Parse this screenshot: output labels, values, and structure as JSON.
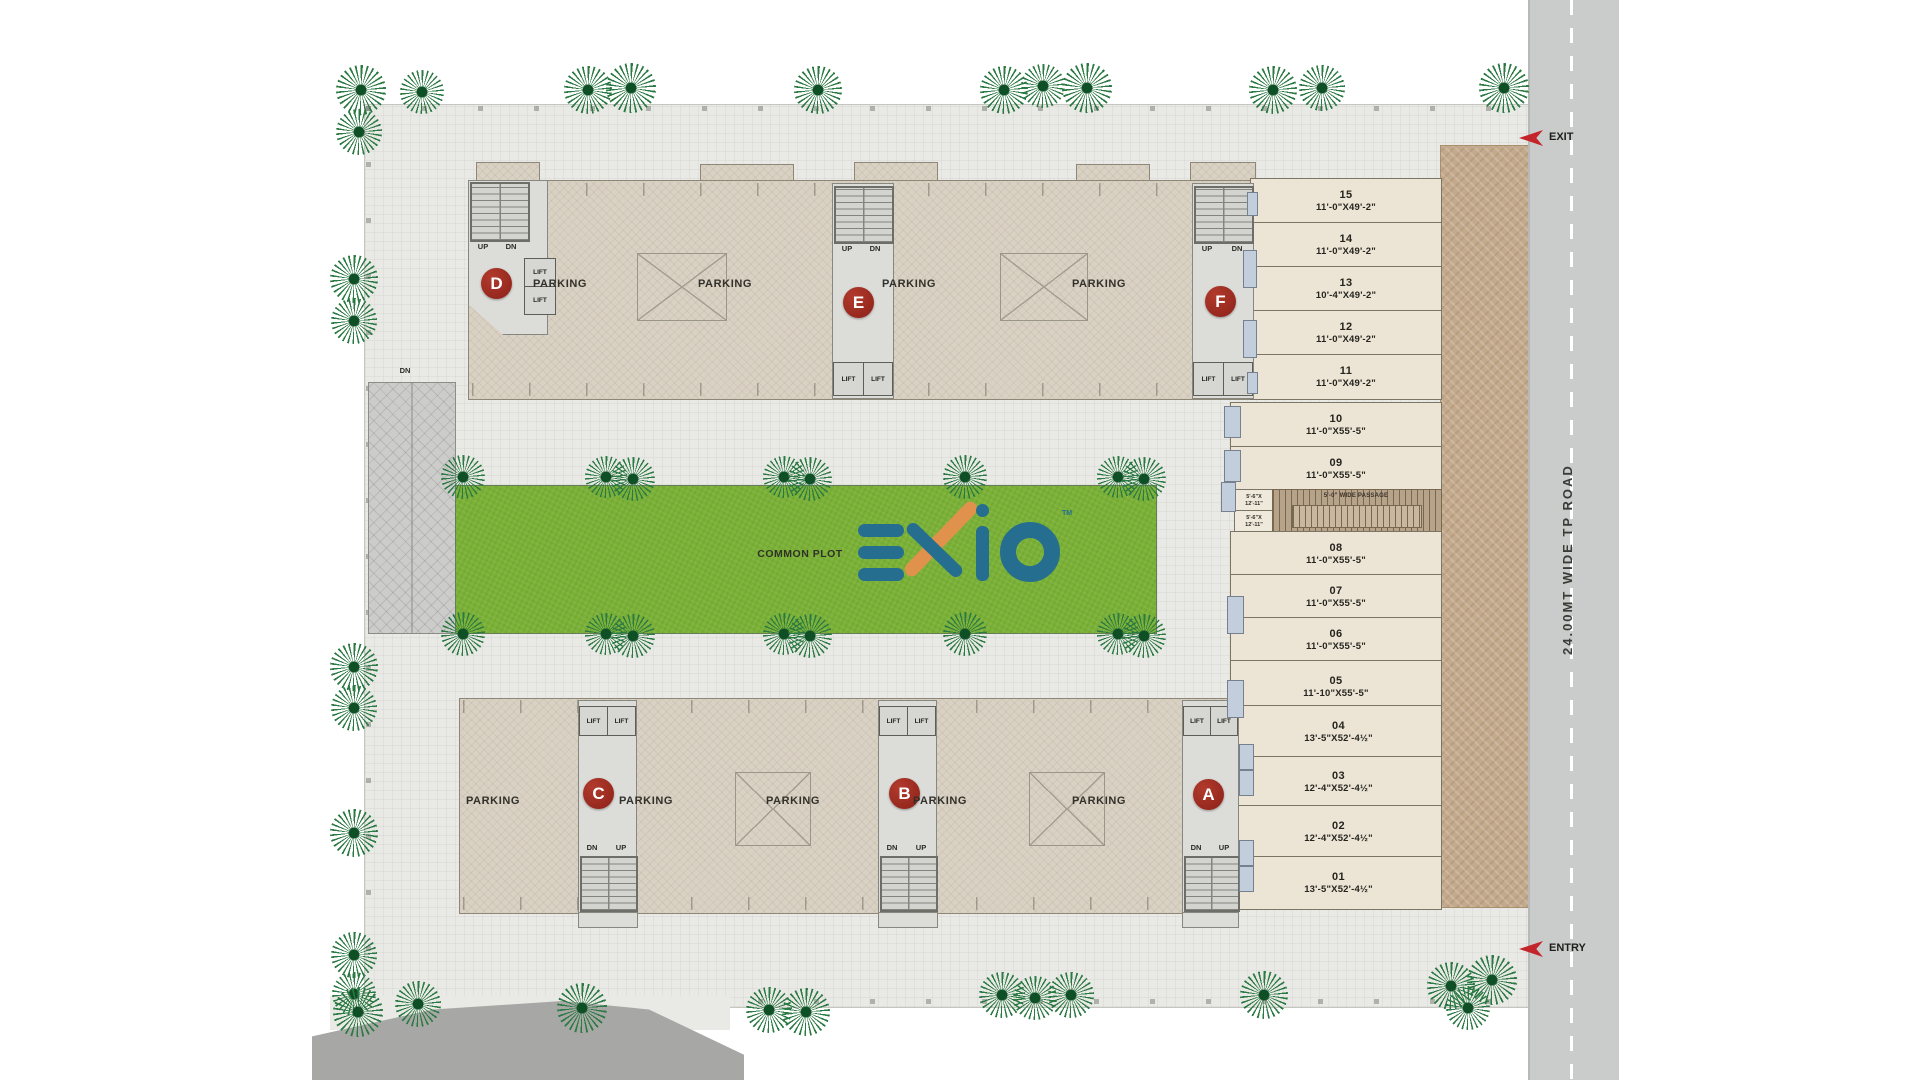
{
  "labels": {
    "common_plot": "COMMON PLOT",
    "parking": "PARKING",
    "road": "24.00MT WIDE TP ROAD",
    "exit": "EXIT",
    "entry": "ENTRY",
    "ramp": "DN",
    "up": "UP",
    "dn": "DN",
    "lift": "LIFT",
    "passage": "5'-0\" WIDE PASSAGE",
    "side_room_l1": "5'-6\"X",
    "side_room_l2": "12'-11\""
  },
  "logo": {
    "text": "EXIO",
    "tm": "TM",
    "blue": "#256e90",
    "orange": "#e0924c"
  },
  "blocks": {
    "letters": [
      "D",
      "E",
      "F",
      "C",
      "B",
      "A"
    ]
  },
  "shops": [
    {
      "num": "15",
      "size": "11'-0\"X49'-2\""
    },
    {
      "num": "14",
      "size": "11'-0\"X49'-2\""
    },
    {
      "num": "13",
      "size": "10'-4\"X49'-2\""
    },
    {
      "num": "12",
      "size": "11'-0\"X49'-2\""
    },
    {
      "num": "11",
      "size": "11'-0\"X49'-2\""
    },
    {
      "num": "10",
      "size": "11'-0\"X55'-5\""
    },
    {
      "num": "09",
      "size": "11'-0\"X55'-5\""
    },
    {
      "num": "08",
      "size": "11'-0\"X55'-5\""
    },
    {
      "num": "07",
      "size": "11'-0\"X55'-5\""
    },
    {
      "num": "06",
      "size": "11'-0\"X55'-5\""
    },
    {
      "num": "05",
      "size": "11'-10\"X55'-5\""
    },
    {
      "num": "04",
      "size": "13'-5\"X52'-4½\""
    },
    {
      "num": "03",
      "size": "12'-4\"X52'-4½\""
    },
    {
      "num": "02",
      "size": "12'-4\"X52'-4½\""
    },
    {
      "num": "01",
      "size": "13'-5\"X52'-4½\""
    }
  ],
  "colors": {
    "grass": "#7ab136",
    "building": "#d9d1c3",
    "shop": "#ece5d6",
    "block_label_red": "#9c2c22",
    "road": "#c9ccca",
    "pavement": "#c4aa8d"
  }
}
